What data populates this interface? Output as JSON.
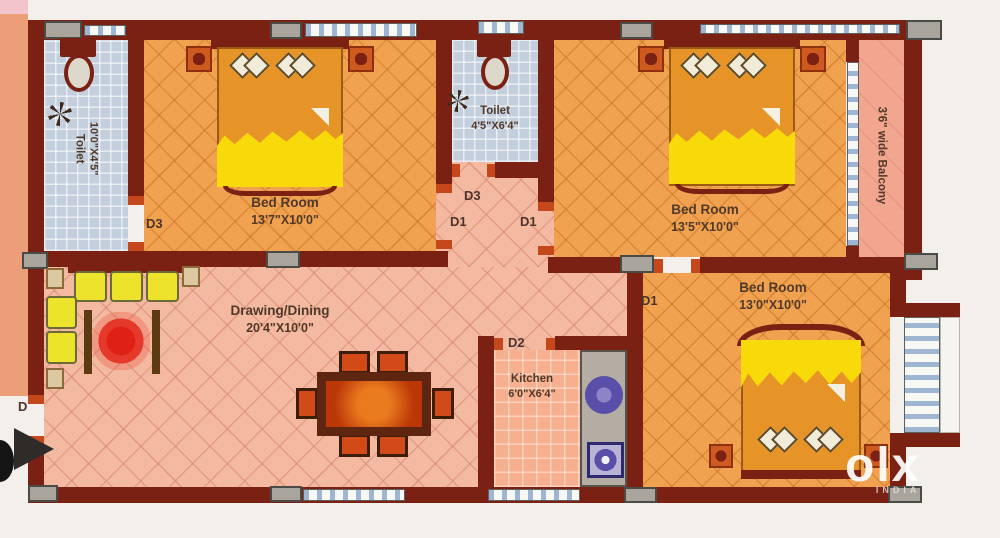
{
  "rooms": {
    "toilet_left": {
      "name": "Toilet",
      "dims": "10'0\"X4'5\""
    },
    "bedroom_tl": {
      "name": "Bed Room",
      "dims": "13'7\"X10'0\""
    },
    "toilet_mid": {
      "name": "Toilet",
      "dims": "4'5\"X6'4\""
    },
    "bedroom_tr": {
      "name": "Bed Room",
      "dims": "13'5\"X10'0\""
    },
    "balcony": {
      "name": "3'6\" wide Balcony"
    },
    "drawing": {
      "name": "Drawing/Dining",
      "dims": "20'4\"X10'0\""
    },
    "kitchen": {
      "name": "Kitchen",
      "dims": "6'0\"X6'4\""
    },
    "bedroom_br": {
      "name": "Bed Room",
      "dims": "13'0\"X10'0\""
    }
  },
  "doors": {
    "entry": "D",
    "d3_bedroom_tl": "D3",
    "d3_toilet_mid": "D3",
    "d1_passage_left": "D1",
    "d1_passage_right": "D1",
    "d1_bedroom_br": "D1",
    "d2_kitchen": "D2"
  },
  "watermark": {
    "brand": "olx",
    "region": "INDIA"
  },
  "colors": {
    "wall": "#7b2114",
    "bedroom_floor": "#f0a250",
    "living_floor": "#f4b9a1",
    "toilet_floor": "#c4cfdd",
    "kitchen_floor": "#f6b08f",
    "balcony_floor": "#f2a58f",
    "blanket_yellow": "#f8d90a",
    "sofa_yellow": "#eee32b",
    "accent_red": "#c5481d",
    "column_gray": "#a9a59d"
  }
}
